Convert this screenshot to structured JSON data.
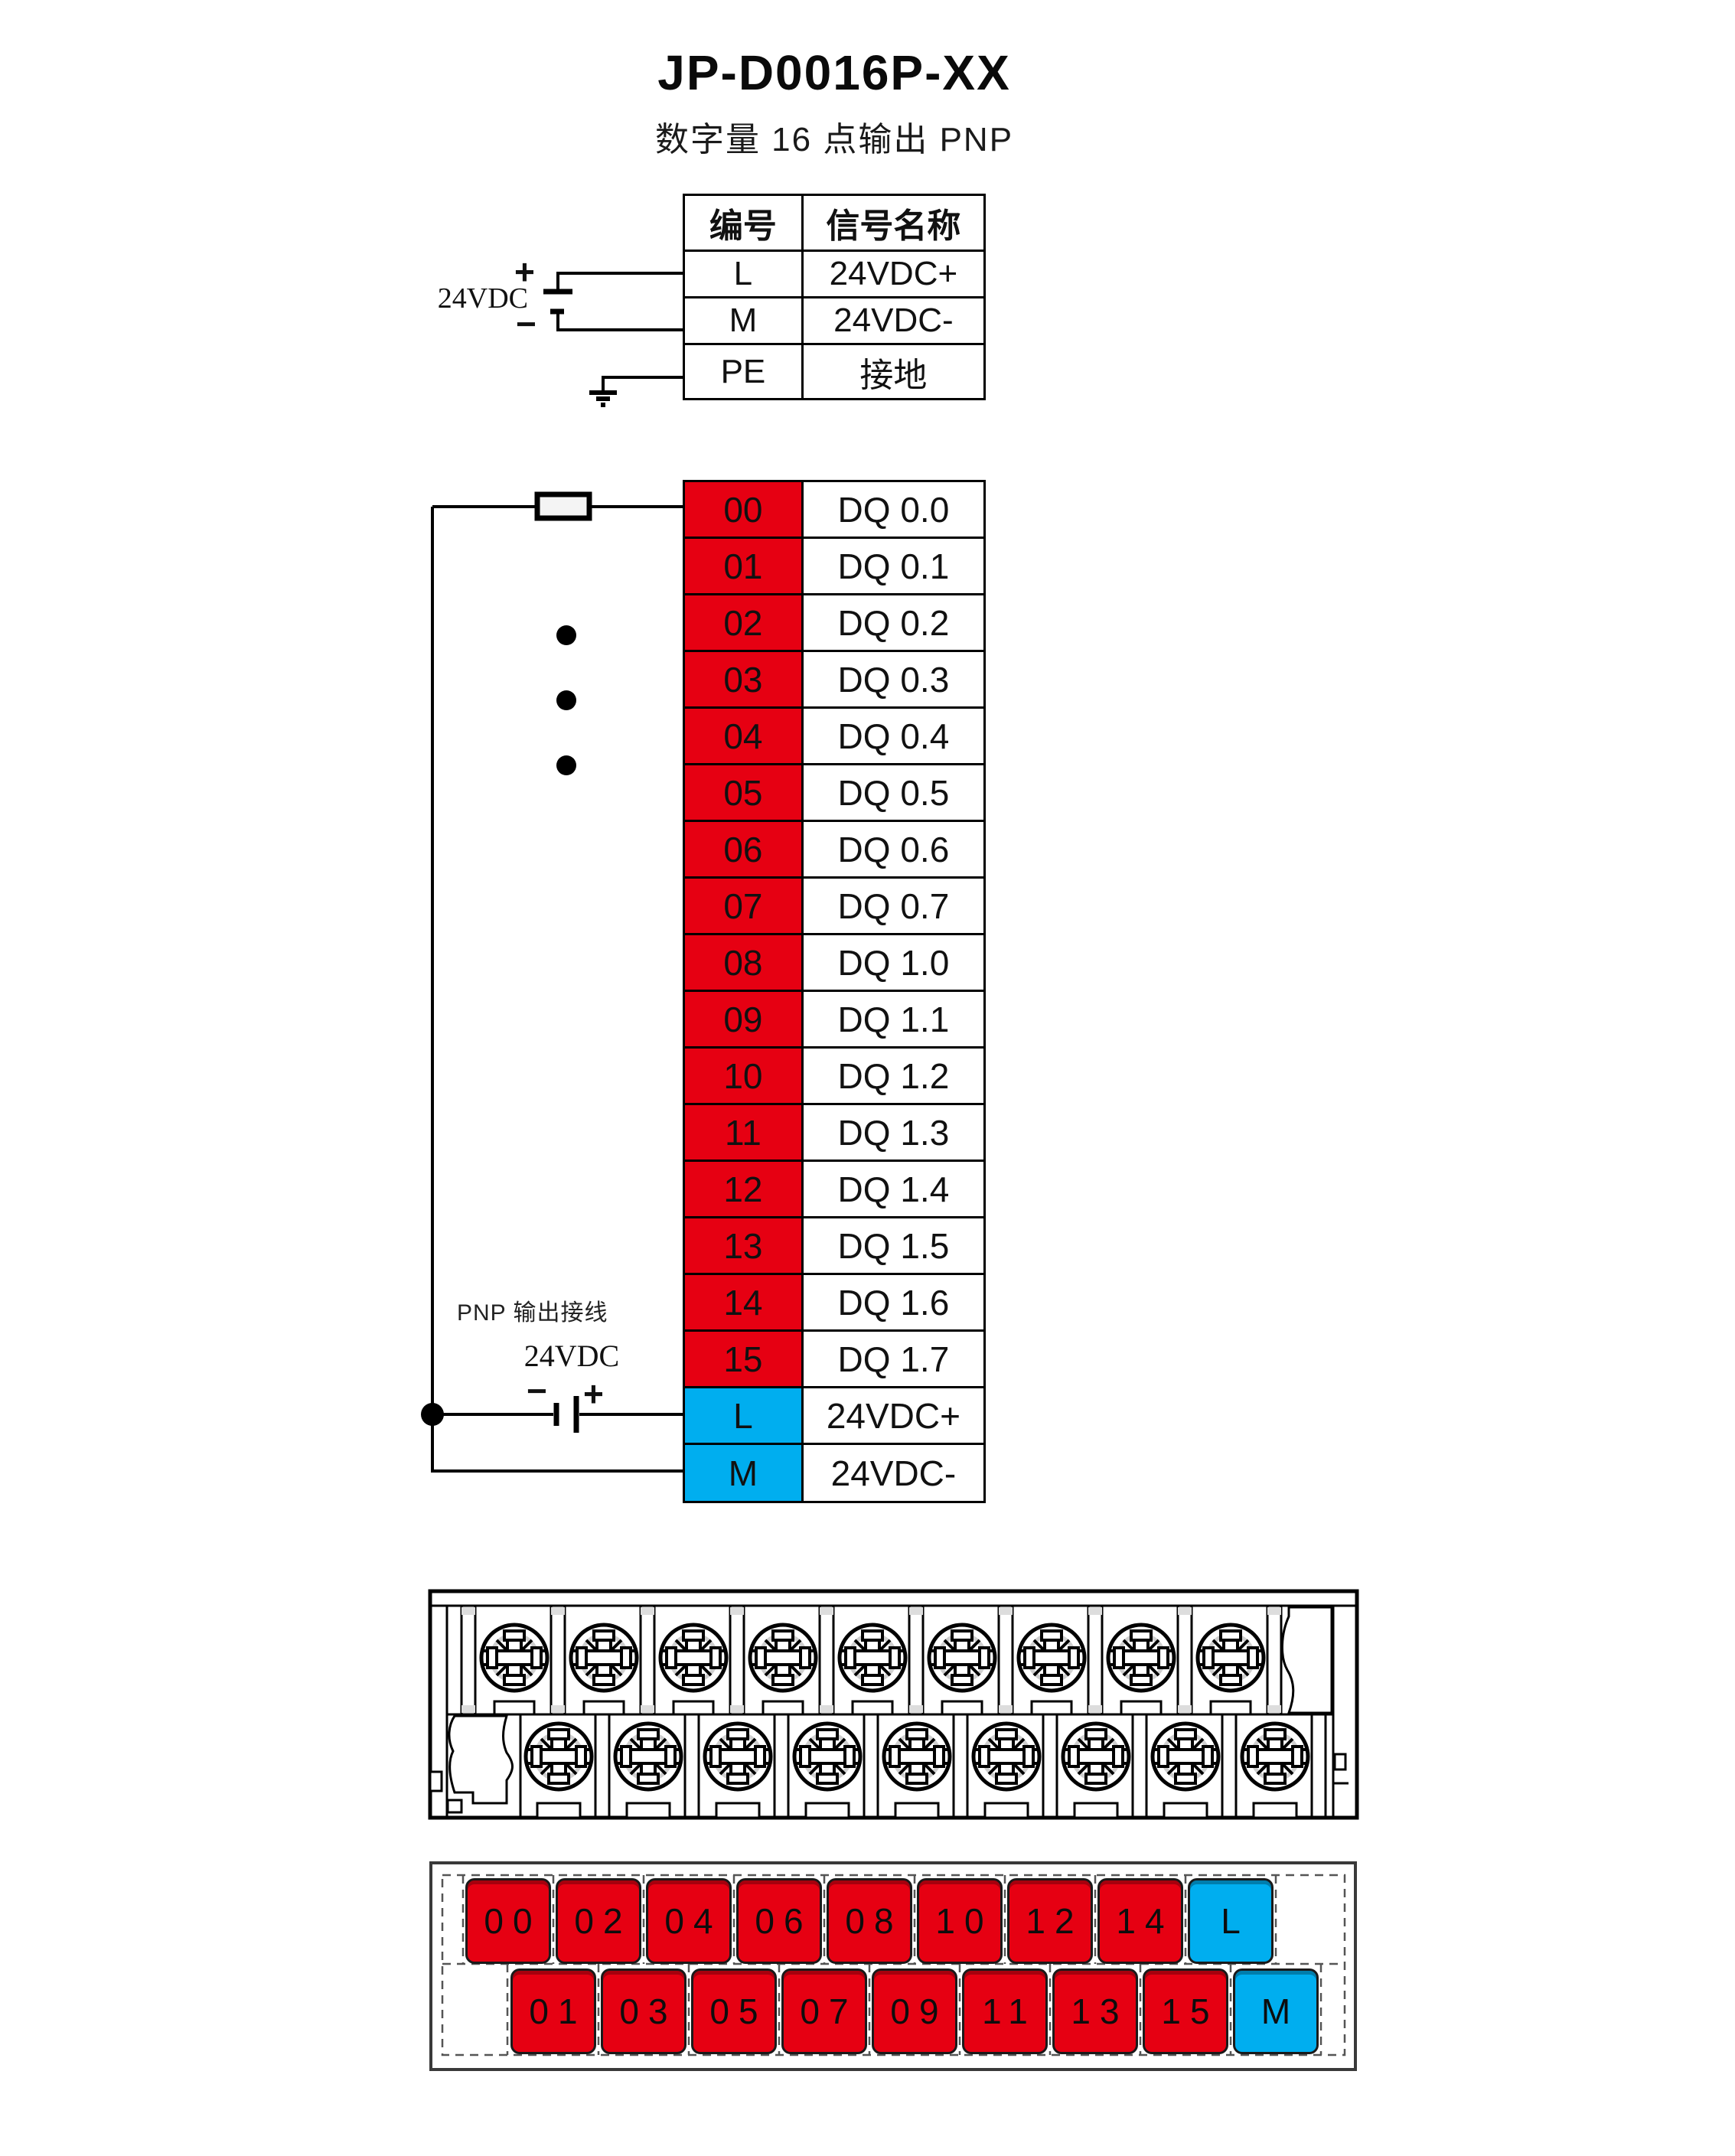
{
  "page": {
    "title": "JP-D0016P-XX",
    "subtitle": "数字量 16 点输出  PNP"
  },
  "colors": {
    "terminal_red": "#e60012",
    "terminal_blue": "#00aeef",
    "line_black": "#000000"
  },
  "power_table": {
    "headers": {
      "no": "编号",
      "name": "信号名称"
    },
    "rows": [
      {
        "no": "L",
        "name": "24VDC+"
      },
      {
        "no": "M",
        "name": "24VDC-"
      },
      {
        "no": "PE",
        "name": "接地"
      }
    ]
  },
  "top_supply": {
    "label": "24VDC",
    "plus": "+",
    "minus": "−"
  },
  "io_table": {
    "rows": [
      {
        "no": "00",
        "name": "DQ 0.0"
      },
      {
        "no": "01",
        "name": "DQ 0.1"
      },
      {
        "no": "02",
        "name": "DQ 0.2"
      },
      {
        "no": "03",
        "name": "DQ 0.3"
      },
      {
        "no": "04",
        "name": "DQ 0.4"
      },
      {
        "no": "05",
        "name": "DQ 0.5"
      },
      {
        "no": "06",
        "name": "DQ 0.6"
      },
      {
        "no": "07",
        "name": "DQ 0.7"
      },
      {
        "no": "08",
        "name": "DQ 1.0"
      },
      {
        "no": "09",
        "name": "DQ 1.1"
      },
      {
        "no": "10",
        "name": "DQ 1.2"
      },
      {
        "no": "11",
        "name": "DQ 1.3"
      },
      {
        "no": "12",
        "name": "DQ 1.4"
      },
      {
        "no": "13",
        "name": "DQ 1.5"
      },
      {
        "no": "14",
        "name": "DQ 1.6"
      },
      {
        "no": "15",
        "name": "DQ 1.7"
      },
      {
        "no": "L",
        "name": "24VDC+"
      },
      {
        "no": "M",
        "name": "24VDC-"
      }
    ]
  },
  "wiring": {
    "label": "PNP 输出接线",
    "supply_label": "24VDC",
    "plus": "+",
    "minus": "−"
  },
  "terminal_panel": {
    "top_row": [
      "00",
      "02",
      "04",
      "06",
      "08",
      "10",
      "12",
      "14",
      "L"
    ],
    "bottom_row": [
      "01",
      "03",
      "05",
      "07",
      "09",
      "11",
      "13",
      "15",
      "M"
    ]
  }
}
